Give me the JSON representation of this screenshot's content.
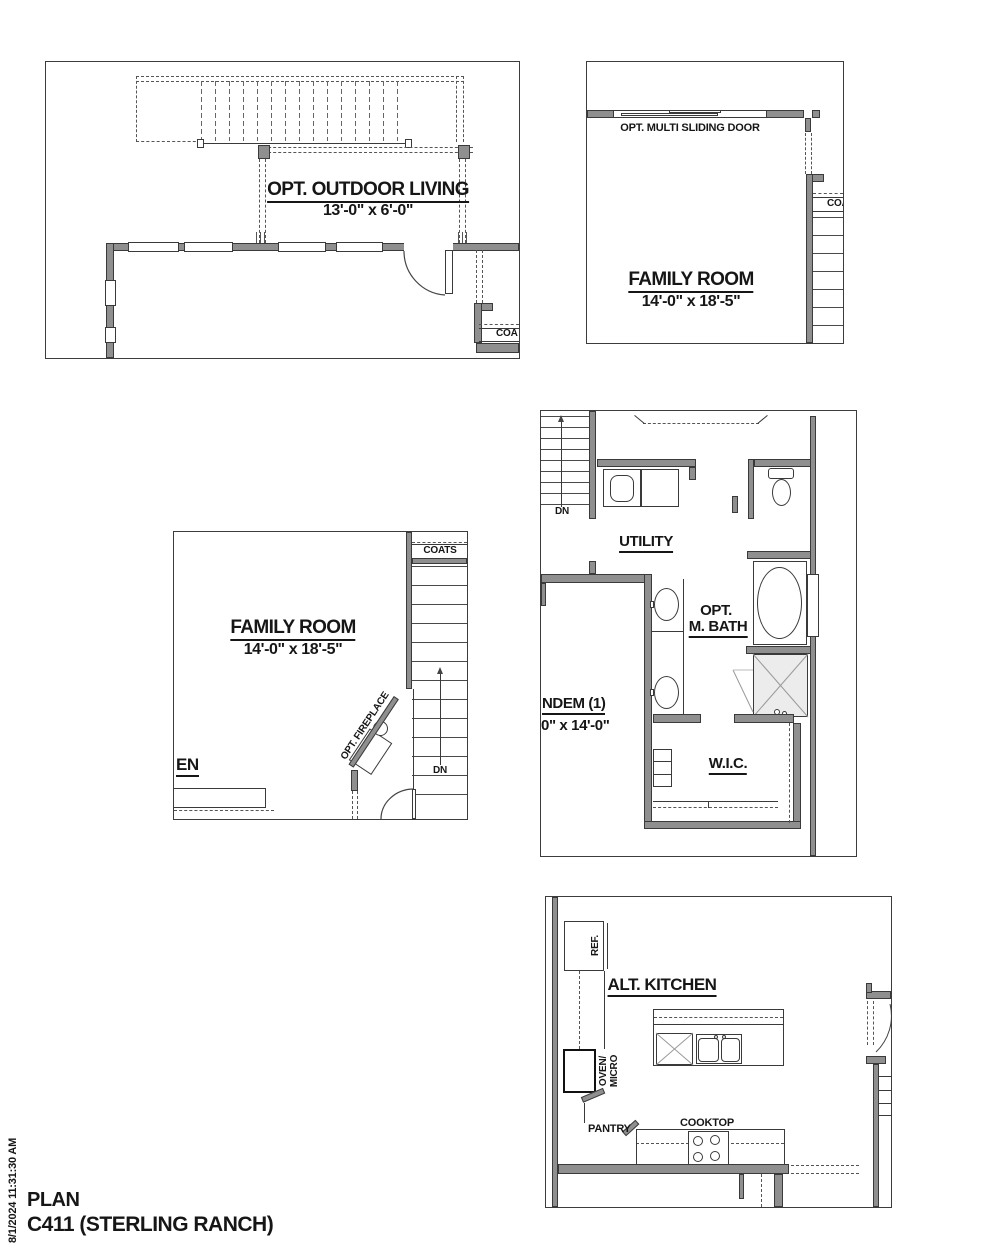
{
  "sheet": {
    "footer": {
      "line1": "PLAN",
      "line2": "C411 (STERLING RANCH)"
    },
    "timestamp": "8/1/2024 11:31:30 AM",
    "colors": {
      "wall_fill": "#8f8f8f",
      "line": "#3a3a3a",
      "text": "#161616",
      "background": "#ffffff"
    }
  },
  "plans": {
    "outdoor_living": {
      "title": "OPT. OUTDOOR LIVING",
      "dims": "13'-0\" x 6'-0\"",
      "closet": "COA"
    },
    "family_room_upper": {
      "title": "FAMILY ROOM",
      "dims": "14'-0\" x 18'-5\"",
      "door": "OPT. MULTI SLIDING DOOR",
      "closet": "COA"
    },
    "family_room_lower": {
      "title": "FAMILY ROOM",
      "dims": "14'-0\" x 18'-5\"",
      "closet": "COATS",
      "fireplace": "OPT. FIREPLACE",
      "stair": "DN",
      "cut_label": "EN"
    },
    "utility_bath": {
      "utility": "UTILITY",
      "bath1": "OPT.",
      "bath2": "M. BATH",
      "wic": "W.I.C.",
      "stair": "DN",
      "tandem": "NDEM (1)",
      "tandem_dims": "0\" x 14'-0\""
    },
    "alt_kitchen": {
      "title": "ALT. KITCHEN",
      "fridge": "REF.",
      "oven1": "OVEN/",
      "oven2": "MICRO",
      "pantry": "PANTRY",
      "cooktop": "COOKTOP"
    }
  }
}
